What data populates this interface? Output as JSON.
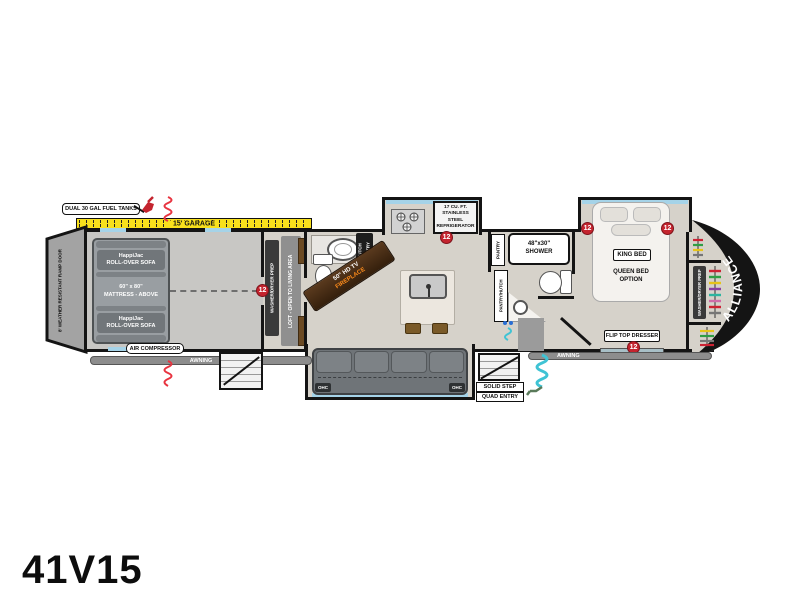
{
  "model": "41V15",
  "brand": "ALLIANCE",
  "marker_value": "12",
  "exterior": {
    "fuel_tanks": "DUAL 30 GAL FUEL TANKS",
    "garage_tape": "15' GARAGE",
    "ramp_door": "8' WEATHER RESISTANT RAMP DOOR",
    "awning_left": "AWNING",
    "awning_right": "AWNING",
    "entry_line1": "SOLID STEP",
    "entry_line2": "QUAD ENTRY"
  },
  "garage": {
    "sofa_top_line1": "HappiJac",
    "sofa_top_line2": "ROLL-OVER SOFA",
    "mattress_line1": "60\" x 80\"",
    "mattress_line2": "MATTRESS - ABOVE",
    "sofa_bottom_line1": "HappiJac",
    "sofa_bottom_line2": "ROLL-OVER SOFA",
    "air_compressor": "AIR COMPRESSOR",
    "washer_dryer_prep": "WASHER/DRYER PREP",
    "loft": "LOFT - OPEN TO LIVING AREA"
  },
  "living": {
    "hutch_line1": "HUTCH",
    "hutch_line2": "PANTRY",
    "tv": "50\" HD TV",
    "fireplace": "FIREPLACE",
    "fridge_line1": "17 CU. FT.",
    "fridge_line2": "STAINLESS STEEL",
    "fridge_line3": "REFRIGERATOR",
    "pantry": "PANTRY",
    "pantry_hutch": "PANTRY/HUTCH",
    "ohc_left": "OHC",
    "ohc_right": "OHC"
  },
  "bathroom": {
    "shower_line1": "48\"x30\"",
    "shower_line2": "SHOWER"
  },
  "bedroom": {
    "king_bed": "KING BED",
    "queen_line1": "QUEEN BED",
    "queen_line2": "OPTION",
    "dresser": "FLIP TOP DRESSER",
    "washer_dryer_prep": "WASHER/DRYER PREP"
  },
  "colors": {
    "floor": "#d6d2ca",
    "garage_floor": "#c8c7c4",
    "wall": "#141414",
    "slide_accent": "#a5d3e8",
    "tape_yellow": "#f8e01c",
    "marker_red": "#c4242e",
    "sofa_gray": "#71767a",
    "cabinet_brown": "#6b4a23",
    "hose_teal": "#3fc3d4",
    "spring_red": "#e8333f",
    "fireplace_orange": "#ff8c1a"
  }
}
